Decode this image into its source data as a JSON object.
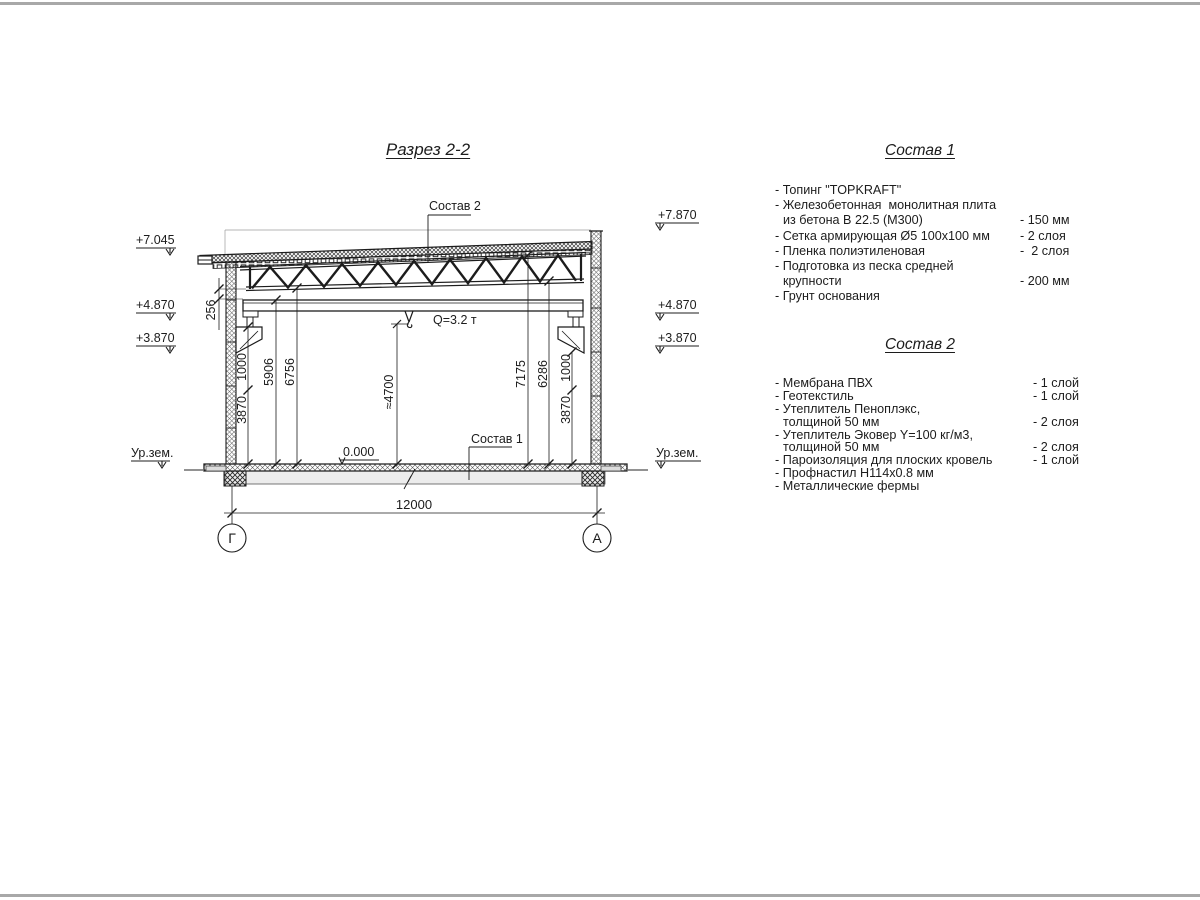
{
  "page": {
    "border_color": "#a8a8a8",
    "line_color": "#1c1c1c"
  },
  "drawing": {
    "title": "Разрез 2-2",
    "callouts": {
      "roof": "Состав 2",
      "floor": "Состав 1"
    },
    "crane_label": "Q=3.2 т",
    "zero_level": "0.000",
    "span_dim": "12000",
    "axes": {
      "left": "Г",
      "right": "А"
    },
    "elevations": {
      "left_top": "+7.045",
      "left_mid": "+4.870",
      "left_low": "+3.870",
      "right_top": "+7.870",
      "right_mid": "+4.870",
      "right_low": "+3.870",
      "ground_left": "Ур.зем.",
      "ground_right": "Ур.зем."
    },
    "dims": {
      "gap": "256",
      "left_3870": "3870",
      "left_1000": "1000",
      "left_5906": "5906",
      "left_6756": "6756",
      "center": "≈4700",
      "right_7175": "7175",
      "right_6286": "6286",
      "right_1000": "1000",
      "right_3870": "3870"
    }
  },
  "spec1": {
    "title": "Состав 1",
    "rows": [
      {
        "text": "- Топинг \"TOPKRAFT\"",
        "value": ""
      },
      {
        "text": "- Железобетонная  монолитная плита",
        "value": ""
      },
      {
        "text": "из бетона В 22.5 (М300)",
        "value": "- 150 мм"
      },
      {
        "text": "- Сетка армирующая Ø5 100х100 мм",
        "value": "- 2 слоя"
      },
      {
        "text": "- Пленка полиэтиленовая",
        "value": "-  2 слоя"
      },
      {
        "text": "- Подготовка из песка средней",
        "value": ""
      },
      {
        "text": "крупности",
        "value": "- 200 мм"
      },
      {
        "text": "- Грунт основания",
        "value": ""
      }
    ]
  },
  "spec2": {
    "title": "Состав 2",
    "rows": [
      {
        "text": "- Мембрана ПВХ",
        "value": "- 1 слой"
      },
      {
        "text": "- Геотекстиль",
        "value": "- 1 слой"
      },
      {
        "text": "- Утеплитель Пеноплэкс,",
        "value": ""
      },
      {
        "text": "толщиной 50 мм",
        "value": "- 2 слоя"
      },
      {
        "text": "- Утеплитель Эковер Y=100 кг/м3,",
        "value": ""
      },
      {
        "text": "толщиной 50 мм",
        "value": "- 2 слоя"
      },
      {
        "text": "- Пароизоляция для плоских кровель",
        "value": "- 1 слой"
      },
      {
        "text": "- Профнастил Н114х0.8 мм",
        "value": ""
      },
      {
        "text": "- Металлические фермы",
        "value": ""
      }
    ]
  }
}
